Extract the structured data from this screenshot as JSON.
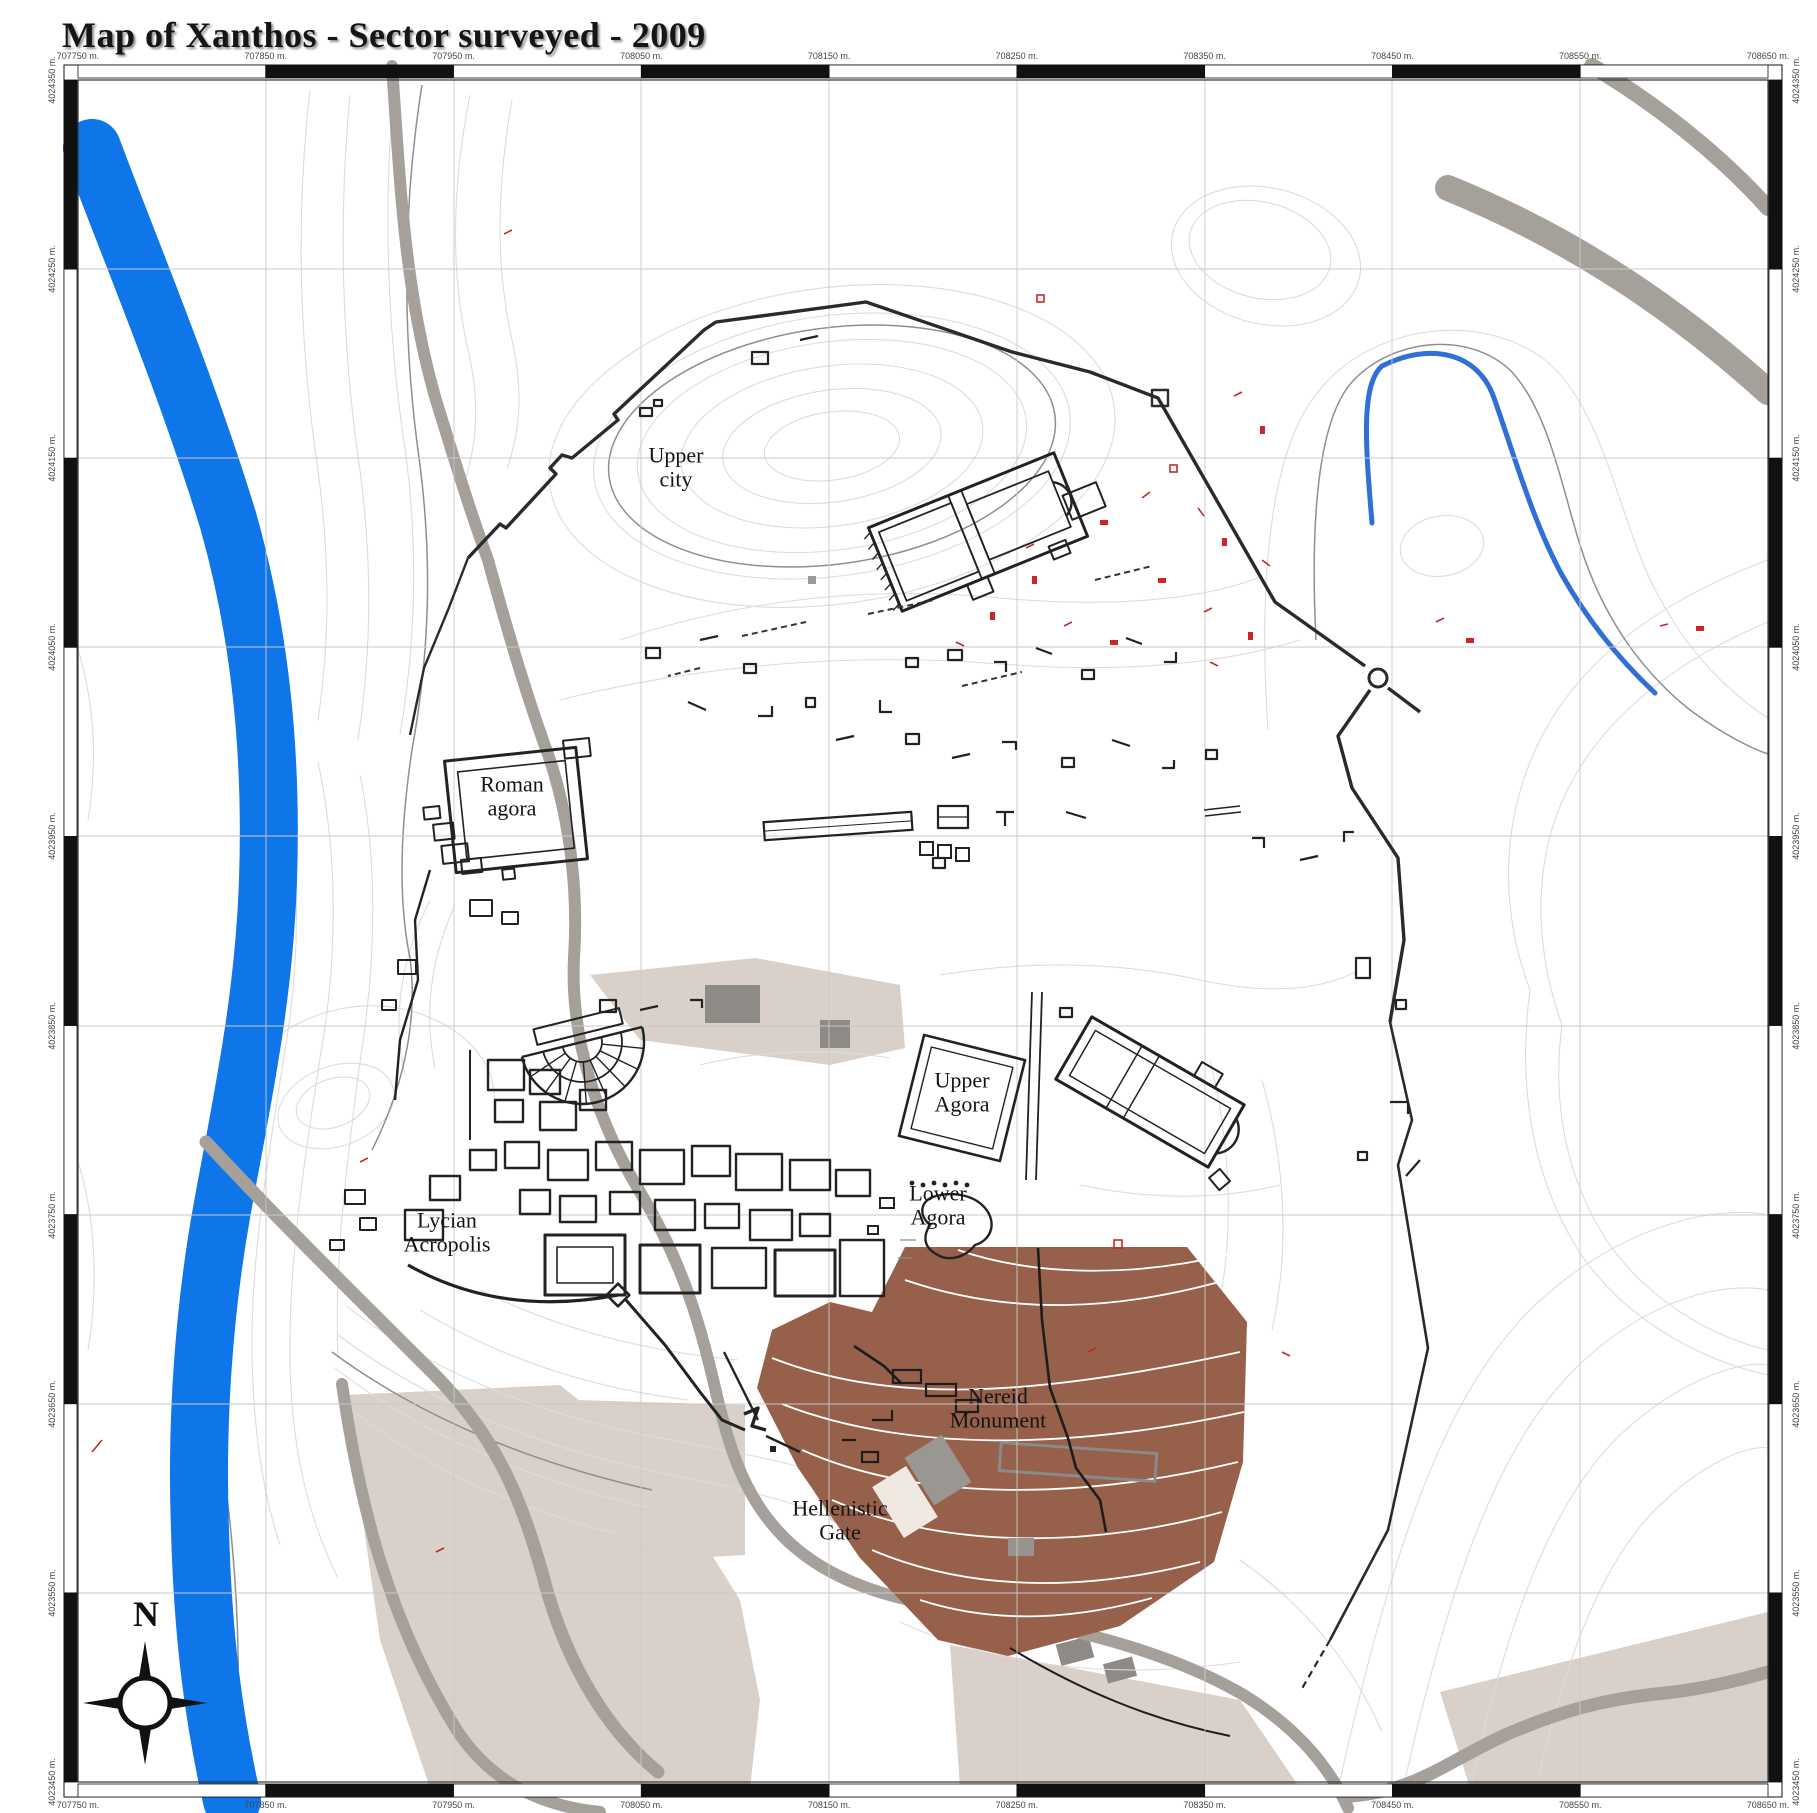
{
  "title": "Map of Xanthos - Sector surveyed - 2009",
  "region_labels": {
    "upper_city": [
      "Upper",
      "city"
    ],
    "roman_agora": [
      "Roman",
      "agora"
    ],
    "upper_agora": [
      "Upper",
      "Agora"
    ],
    "lower_agora": [
      "Lower",
      "Agora"
    ],
    "lycian_acropolis": [
      "Lycian",
      "Acropolis"
    ],
    "nereid_monument": [
      "Nereid",
      "Monument"
    ],
    "hellenistic_gate": [
      "Hellenistic",
      "Gate"
    ]
  },
  "compass": {
    "north_label": "N"
  },
  "frame": {
    "unit_suffix": "m.",
    "top_labels": [
      "707750 m.",
      "707850 m.",
      "707950 m.",
      "708050 m.",
      "708150 m.",
      "708250 m.",
      "708350 m.",
      "708450 m.",
      "708550 m.",
      "708650 m."
    ],
    "bottom_labels": [
      "707750 m.",
      "707850 m.",
      "707950 m.",
      "708050 m.",
      "708150 m.",
      "708250 m.",
      "708350 m.",
      "708450 m.",
      "708550 m.",
      "708650 m."
    ],
    "left_labels": [
      "4024350 m.",
      "4024250 m.",
      "4024150 m.",
      "4024050 m.",
      "4023950 m.",
      "4023850 m.",
      "4023750 m.",
      "4023650 m.",
      "4023550 m.",
      "4023450 m."
    ],
    "right_labels": [
      "4024350 m.",
      "4024250 m.",
      "4024150 m.",
      "4024050 m.",
      "4023950 m.",
      "4023850 m.",
      "4023750 m.",
      "4023650 m.",
      "4023550 m.",
      "4023450 m."
    ]
  },
  "colors": {
    "river": "#0e76e8",
    "stream": "#2f6fd6",
    "surveyed_sector": "#96604a",
    "roads": "#a5a09a",
    "fields": "#d8d0c9",
    "contours": "#dcdcdc",
    "index_contours": "#8f8f8f",
    "structures": "#222222",
    "survey_marks": "#c62828"
  }
}
